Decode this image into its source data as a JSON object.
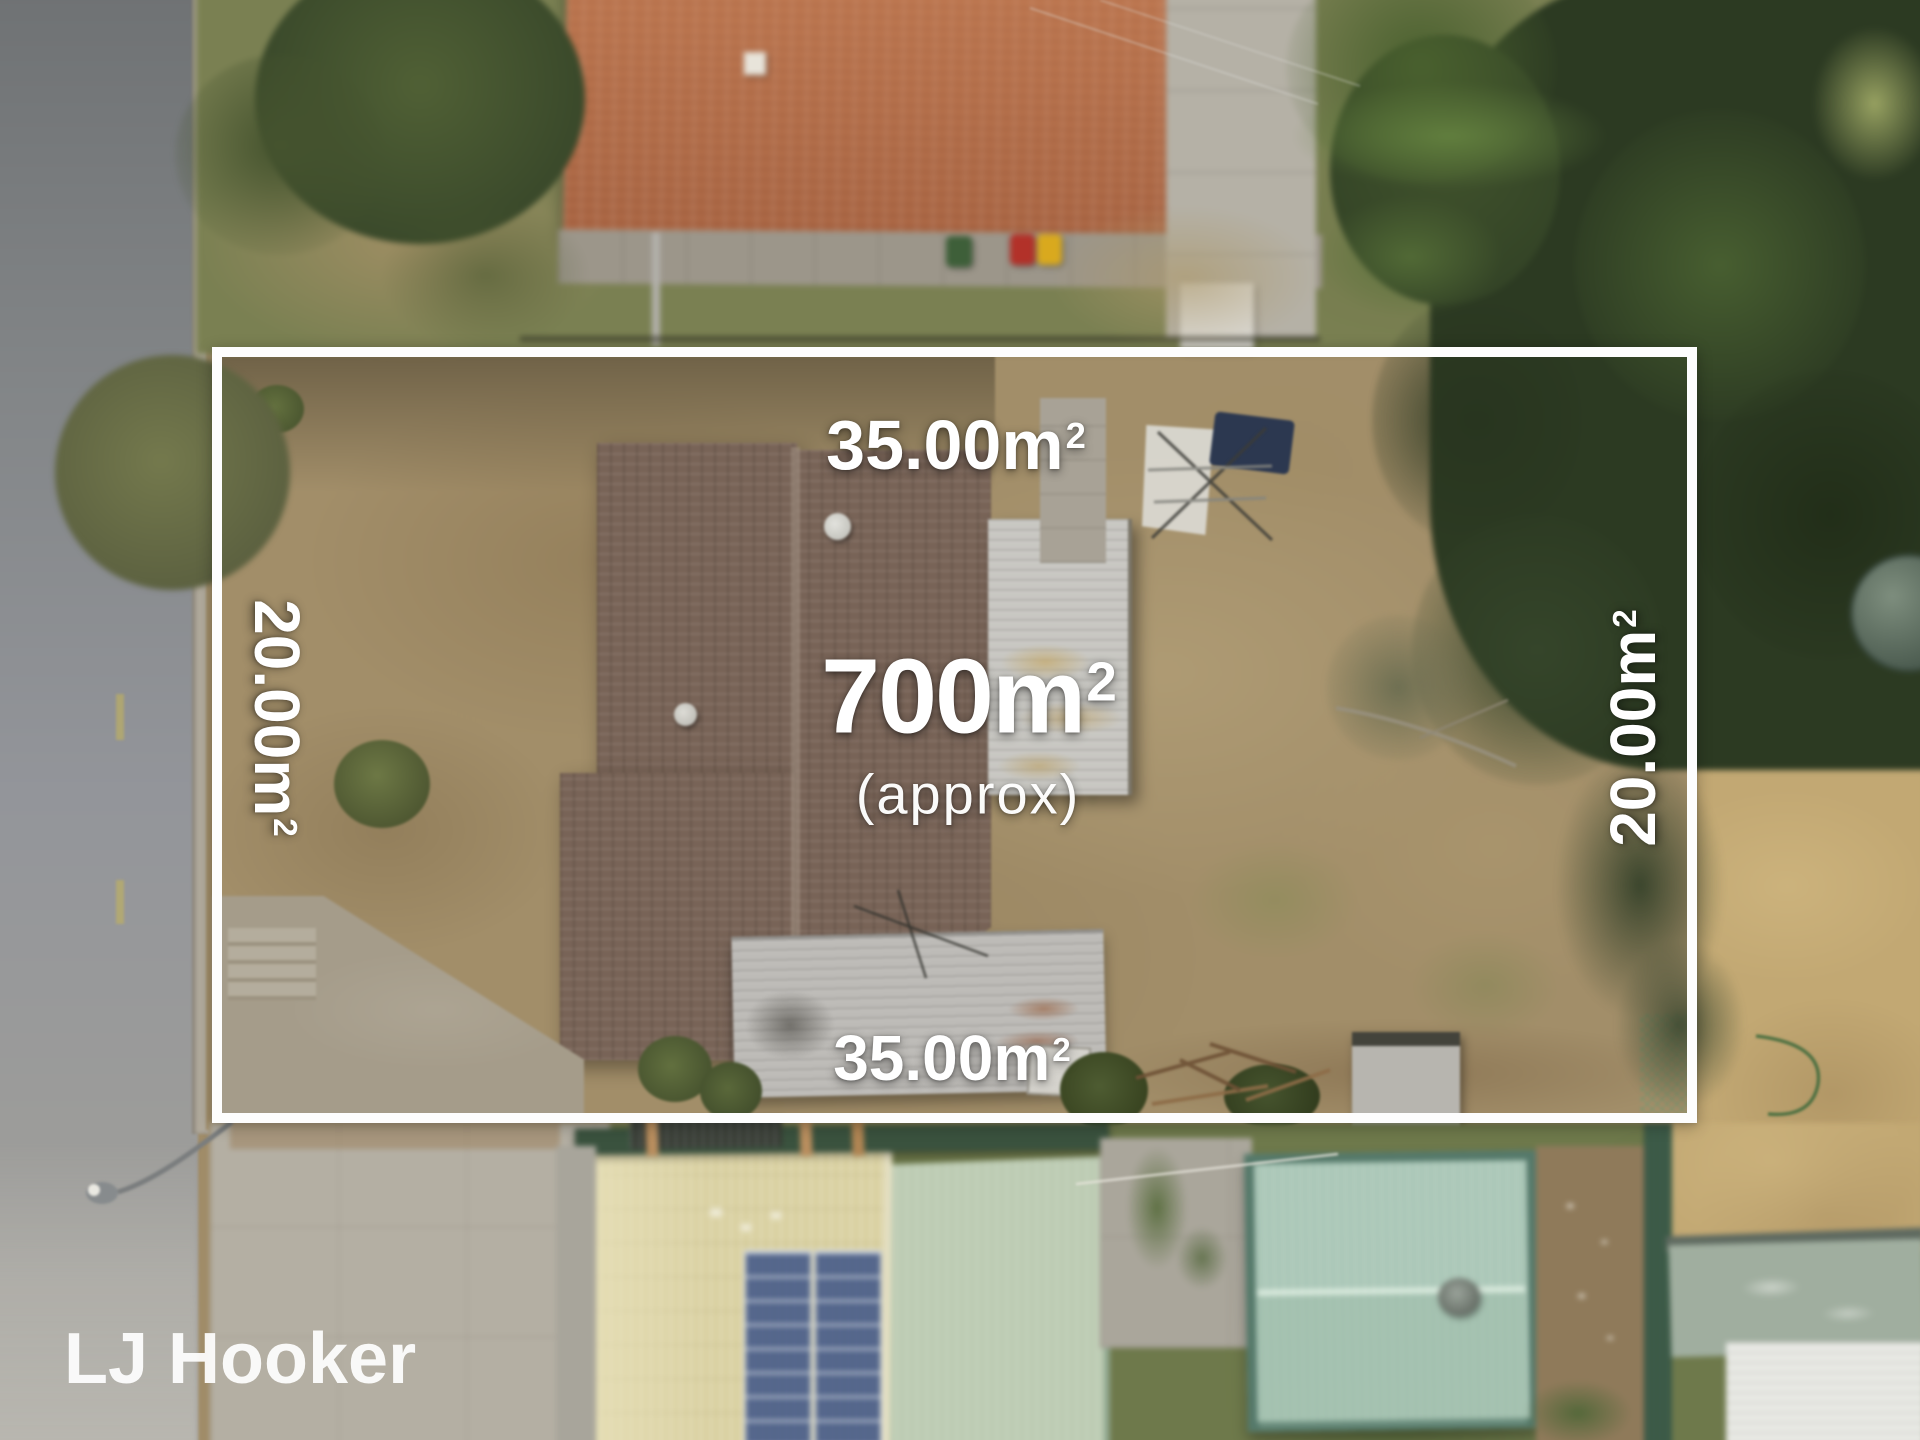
{
  "brand": {
    "watermark": "LJ Hooker"
  },
  "overlay": {
    "total_area": {
      "value": "700m",
      "sup": "2"
    },
    "qualifier": "(approx)",
    "boundary": {
      "top": {
        "value": "35.00m",
        "sup": "2"
      },
      "bottom": {
        "value": "35.00m",
        "sup": "2"
      },
      "left": {
        "value": "20.00m",
        "sup": "2"
      },
      "right": {
        "value": "20.00m",
        "sup": "2"
      }
    },
    "colors": {
      "boundary_line": "#ffffff",
      "label_text": "#ffffff"
    }
  }
}
